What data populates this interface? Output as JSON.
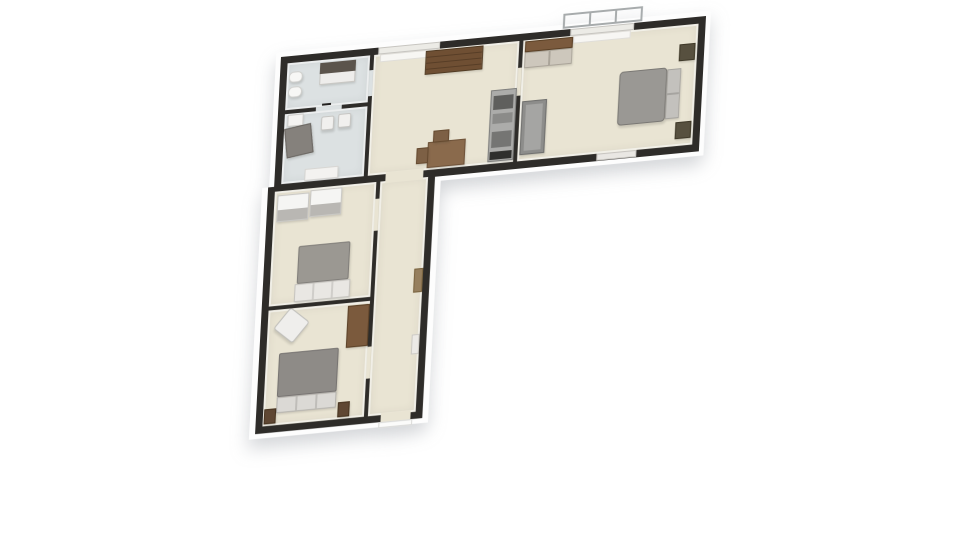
{
  "scene": {
    "background": "#ffffff",
    "colors": {
      "wall": "#2e2c29",
      "wood": "#e9e4d3",
      "tile": "#dce1e2",
      "plinth": "#fdfdfd"
    }
  },
  "plan": {
    "plinths": [
      {
        "n": "plinth-top-wing",
        "x": -5,
        "y": -5,
        "w": 437,
        "h": 145
      },
      {
        "n": "plinth-left-wing",
        "x": -12,
        "y": 130,
        "w": 180,
        "h": 252
      }
    ],
    "bases": [
      {
        "n": "base-top-wing",
        "x": 0,
        "y": 0,
        "w": 427,
        "h": 135
      },
      {
        "n": "base-left-wing",
        "x": -6,
        "y": 130,
        "w": 168,
        "h": 247
      }
    ],
    "rooms": [
      {
        "n": "bathroom",
        "x": 7,
        "y": 7,
        "w": 83,
        "h": 47,
        "f": "tile"
      },
      {
        "n": "utility-room",
        "x": 7,
        "y": 58,
        "w": 83,
        "h": 70,
        "f": "tile"
      },
      {
        "n": "kitchen-dining",
        "x": 94,
        "y": 7,
        "w": 146,
        "h": 121,
        "f": "wood"
      },
      {
        "n": "bedroom-right",
        "x": 244,
        "y": 7,
        "w": 176,
        "h": 121,
        "f": "wood"
      },
      {
        "n": "bedroom-upper",
        "x": 1,
        "y": 135,
        "w": 102,
        "h": 115,
        "f": "wood"
      },
      {
        "n": "bedroom-lower",
        "x": 1,
        "y": 254,
        "w": 102,
        "h": 116,
        "f": "wood"
      },
      {
        "n": "hallway",
        "x": 107,
        "y": 135,
        "w": 48,
        "h": 235,
        "f": "wood"
      }
    ],
    "openings": [
      {
        "n": "doorway-hall-kitchen",
        "x": 112,
        "y": 126,
        "w": 38,
        "h": 11,
        "f": "wood"
      },
      {
        "n": "door-bathroom",
        "x": 90,
        "y": 22,
        "w": 4,
        "h": 26,
        "f": "tile"
      },
      {
        "n": "door-bath-utility",
        "x": 38,
        "y": 54,
        "w": 26,
        "h": 4,
        "f": "tile"
      },
      {
        "n": "door-bedroom-right",
        "x": 240,
        "y": 34,
        "w": 4,
        "h": 28,
        "f": "wood"
      },
      {
        "n": "door-bedroom-upper",
        "x": 103,
        "y": 152,
        "w": 4,
        "h": 32,
        "f": "wood"
      },
      {
        "n": "door-bedroom-lower",
        "x": 103,
        "y": 300,
        "w": 4,
        "h": 32,
        "f": "wood"
      },
      {
        "n": "entrance-doorway",
        "x": 120,
        "y": 368,
        "w": 30,
        "h": 9,
        "f": "wood"
      },
      {
        "n": "window-kitchen",
        "x": 98,
        "y": 0,
        "w": 62,
        "h": 7,
        "c": "#ecebe6",
        "b": "#c7c5c0"
      },
      {
        "n": "window-bedroom-top",
        "x": 291,
        "y": 0,
        "w": 64,
        "h": 7,
        "c": "#ecebe6",
        "b": "#c7c5c0"
      },
      {
        "n": "window-bedroom-bottom",
        "x": 324,
        "y": 128,
        "w": 40,
        "h": 7,
        "c": "#e9e7e3",
        "b": "#c7c5c0"
      }
    ],
    "furniture": [
      {
        "n": "bathroom-vanity-base",
        "x": 40,
        "y": 10,
        "w": 36,
        "h": 22,
        "c": "#eeedeb",
        "b": "#c9c7c3"
      },
      {
        "n": "bathroom-vanity-top",
        "x": 40,
        "y": 10,
        "w": 36,
        "h": 11,
        "c": "#5b544c",
        "flat": true
      },
      {
        "n": "toilet",
        "x": 9,
        "y": 16,
        "w": 14,
        "h": 11,
        "c": "#f7f7f5",
        "b": "#cfcfcc",
        "r": 5
      },
      {
        "n": "bathroom-sink",
        "x": 9,
        "y": 31,
        "w": 14,
        "h": 11,
        "c": "#f7f7f5",
        "b": "#cfcfcc",
        "r": 5
      },
      {
        "n": "door-handle-mark",
        "x": 44,
        "y": 51,
        "w": 9,
        "h": 2,
        "c": "#22201e",
        "flat": true
      },
      {
        "n": "utility-cabinet",
        "x": 10,
        "y": 59,
        "w": 16,
        "h": 12,
        "c": "#f4f3f1",
        "b": "#cfcecb"
      },
      {
        "n": "utility-armchair",
        "x": 9,
        "y": 71,
        "w": 27,
        "h": 30,
        "c": "#85817c",
        "b": "#6a6661",
        "rot": -8
      },
      {
        "n": "utility-chair-a",
        "x": 44,
        "y": 64,
        "w": 13,
        "h": 14,
        "c": "#f1f0ee",
        "b": "#c6c5c2",
        "r": 2
      },
      {
        "n": "utility-chair-b",
        "x": 61,
        "y": 63,
        "w": 13,
        "h": 14,
        "c": "#f1f0ee",
        "b": "#c6c5c2",
        "r": 2
      },
      {
        "n": "utility-table",
        "x": 30,
        "y": 115,
        "w": 34,
        "h": 12,
        "c": "#f3f2f0",
        "b": "#d6d5d2"
      },
      {
        "n": "kitchen-window-sill",
        "x": 100,
        "y": 7,
        "w": 58,
        "h": 8,
        "c": "#f7f6f3",
        "b": "#e0ded9",
        "flat": true
      },
      {
        "n": "sideboard",
        "x": 146,
        "y": 8,
        "w": 58,
        "h": 24,
        "g": "repeating-linear-gradient(180deg,#6f4f33 0px,#6f4f33 5px,#573d26 5px,#573d26 6px)",
        "b": "#4e3820"
      },
      {
        "n": "appliance-column",
        "x": 214,
        "y": 54,
        "w": 26,
        "h": 72,
        "c": "#acacaa",
        "b": "#7e7e7c"
      },
      {
        "n": "appliance-oven",
        "x": 217,
        "y": 60,
        "w": 20,
        "h": 14,
        "c": "#5f5f5d",
        "flat": true
      },
      {
        "n": "appliance-mid-drawer",
        "x": 217,
        "y": 78,
        "w": 20,
        "h": 10,
        "c": "#8b8b89",
        "flat": true
      },
      {
        "n": "appliance-lower-drawer",
        "x": 217,
        "y": 96,
        "w": 20,
        "h": 16,
        "c": "#757573",
        "flat": true
      },
      {
        "n": "appliance-base",
        "x": 216,
        "y": 116,
        "w": 22,
        "h": 8,
        "c": "#2f2f2d",
        "flat": true
      },
      {
        "n": "dining-table",
        "x": 153,
        "y": 100,
        "w": 38,
        "h": 26,
        "c": "#8a6a4c",
        "b": "#6d5138"
      },
      {
        "n": "dining-chair-a",
        "x": 142,
        "y": 105,
        "w": 12,
        "h": 16,
        "c": "#7d6045",
        "b": "#64492f"
      },
      {
        "n": "dining-chair-b",
        "x": 158,
        "y": 89,
        "w": 16,
        "h": 12,
        "c": "#7d6045",
        "b": "#64492f"
      },
      {
        "n": "bedroom-window-sill",
        "x": 294,
        "y": 7,
        "w": 58,
        "h": 8,
        "c": "#f7f6f3",
        "b": "#e0ded9",
        "flat": true
      },
      {
        "n": "wardrobe-top",
        "x": 246,
        "y": 8,
        "w": 48,
        "h": 11,
        "c": "#7b5a3d",
        "b": "#5a4026"
      },
      {
        "n": "wardrobe-doors",
        "x": 246,
        "y": 19,
        "w": 48,
        "h": 16,
        "g": "linear-gradient(90deg,#cdc7bc 0px,#cdc7bc 23px,#aaa499 23px,#aaa499 25px,#cdc7bc 25px,#cdc7bc 48px)",
        "b": "#a9a398"
      },
      {
        "n": "bedroom-sofa",
        "x": 246,
        "y": 68,
        "w": 25,
        "h": 54,
        "c": "#8d8d8b",
        "b": "#6f6f6d"
      },
      {
        "n": "bedroom-sofa-seat",
        "x": 250,
        "y": 72,
        "w": 17,
        "h": 46,
        "c": "#a5a5a3",
        "flat": true
      },
      {
        "n": "bed-blanket",
        "x": 343,
        "y": 48,
        "w": 48,
        "h": 54,
        "c": "#9a9894",
        "b": "#7a7874",
        "r": 4
      },
      {
        "n": "bed-pillows",
        "x": 391,
        "y": 50,
        "w": 14,
        "h": 50,
        "g": "linear-gradient(180deg,#c3c1bd 0px,#c3c1bd 23px,#a6a4a0 23px,#a6a4a0 25px,#c3c1bd 25px,#c3c1bd 50px)",
        "b": "#a3a19d"
      },
      {
        "n": "nightstand-a",
        "x": 402,
        "y": 26,
        "w": 16,
        "h": 17,
        "c": "#57503f",
        "b": "#3e3828"
      },
      {
        "n": "nightstand-b",
        "x": 402,
        "y": 104,
        "w": 16,
        "h": 17,
        "c": "#57503f",
        "b": "#3e3828"
      },
      {
        "n": "balcony-railing",
        "x": 283,
        "y": -16,
        "w": 80,
        "h": 15,
        "g": "repeating-linear-gradient(90deg,transparent 0px,transparent 24px,#a7abac 24px,#a7abac 26px)",
        "b": "#a7abac",
        "bw": 2,
        "flat": true
      },
      {
        "n": "wardrobe-a",
        "x": 4,
        "y": 139,
        "w": 32,
        "h": 27,
        "g": "linear-gradient(180deg,#f5f5f3 0%,#f5f5f3 55%,#b9b7b3 55%,#b9b7b3 100%)",
        "b": "#c9c8c5"
      },
      {
        "n": "wardrobe-b",
        "x": 37,
        "y": 137,
        "w": 32,
        "h": 27,
        "g": "linear-gradient(180deg,#f5f5f3 0%,#f5f5f3 55%,#b9b7b3 55%,#b9b7b3 100%)",
        "b": "#c9c8c5"
      },
      {
        "n": "bed-upper-blanket",
        "x": 28,
        "y": 192,
        "w": 52,
        "h": 38,
        "c": "#9b9892",
        "b": "#7f7c78",
        "r": 2
      },
      {
        "n": "bed-upper-foot",
        "x": 26,
        "y": 230,
        "w": 56,
        "h": 18,
        "g": "repeating-linear-gradient(90deg,#e9e7e3 0px,#e9e7e3 17px,#cfcdc9 17px,#cfcdc9 19px)",
        "b": "#c6c4c0"
      },
      {
        "n": "armchair",
        "x": 12,
        "y": 258,
        "w": 26,
        "h": 26,
        "c": "#efeeec",
        "b": "#c0bfbb",
        "rot": 40,
        "r": 3
      },
      {
        "n": "wardrobe-lower",
        "x": 81,
        "y": 257,
        "w": 22,
        "h": 42,
        "c": "#7b5a3d",
        "b": "#5a4026"
      },
      {
        "n": "bed-lower-blanket",
        "x": 14,
        "y": 298,
        "w": 60,
        "h": 44,
        "c": "#8e8b87",
        "b": "#757270",
        "r": 2
      },
      {
        "n": "bed-lower-headboard",
        "x": 14,
        "y": 342,
        "w": 60,
        "h": 16,
        "g": "repeating-linear-gradient(90deg,#dbd9d5 0px,#dbd9d5 18px,#bfbdb9 18px,#bfbdb9 20px)",
        "b": "#b5b3af"
      },
      {
        "n": "nightstand-c",
        "x": 2,
        "y": 353,
        "w": 12,
        "h": 15,
        "c": "#5f4733",
        "b": "#46331f"
      },
      {
        "n": "nightstand-d",
        "x": 76,
        "y": 353,
        "w": 12,
        "h": 15,
        "c": "#5f4733",
        "b": "#46331f"
      },
      {
        "n": "hall-shelf",
        "x": 146,
        "y": 226,
        "w": 9,
        "h": 24,
        "c": "#967f5e",
        "b": "#79633f",
        "flat": true
      },
      {
        "n": "hall-radiator",
        "x": 147,
        "y": 292,
        "w": 8,
        "h": 20,
        "c": "#eceae6",
        "b": "#ccc9c4",
        "flat": true
      },
      {
        "n": "entrance-step",
        "x": 118,
        "y": 377,
        "w": 34,
        "h": 6,
        "c": "#fbfbfa",
        "b": "#d9d9d7",
        "flat": true
      }
    ]
  }
}
